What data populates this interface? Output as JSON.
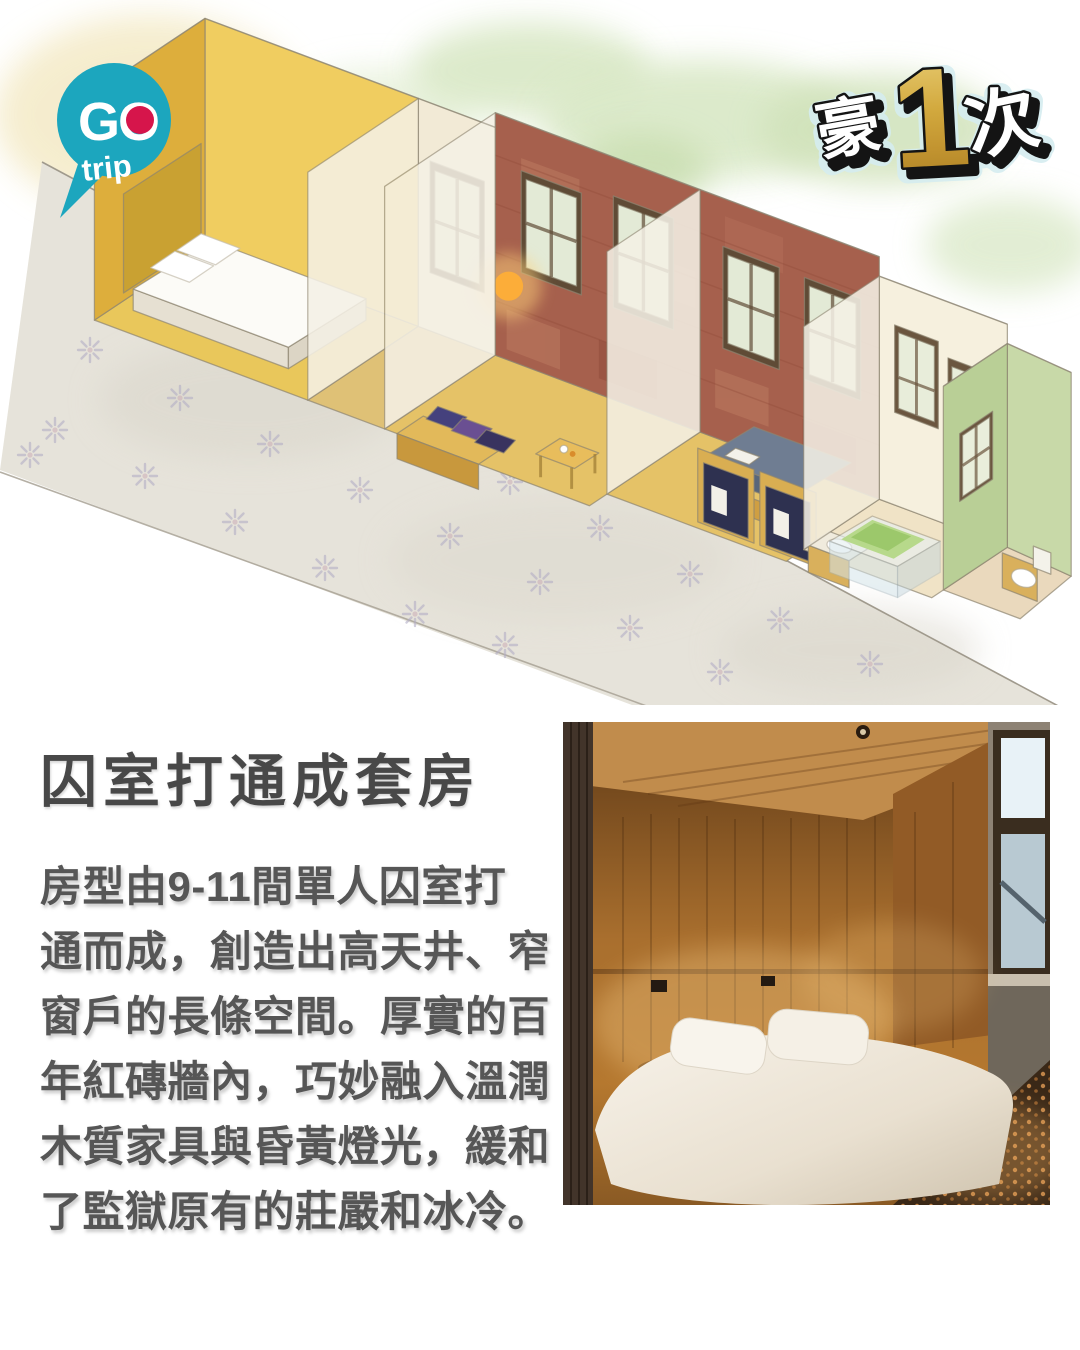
{
  "brand": {
    "go": "GO",
    "trip": "trip"
  },
  "badge": {
    "left": "豪",
    "number": "1",
    "right": "次"
  },
  "article": {
    "heading": "囚室打通成套房",
    "body_lines": [
      "房型由9-11間單人囚室打",
      "通而成，創造出高天井、窄",
      "窗戶的長條空間。厚實的百",
      "年紅磚牆內，巧妙融入溫潤",
      "木質家具與昏黃燈光，緩和",
      "了監獄原有的莊嚴和冰冷。"
    ]
  },
  "palette": {
    "bubble_teal": "#1ca6be",
    "logo_dot_red": "#d6154b",
    "badge_gold": "#cfa43b",
    "heading_gray": "#484848",
    "body_gray": "#565656",
    "walkway_gray": "#e6e3da",
    "starburst_lilac": "#b2aec5",
    "brick_red": "#a6604d",
    "wood_yellow": "#eac75b",
    "toilet_wall_green": "#b9cf96",
    "wash_green": "#d9e8c6",
    "wash_cream": "#f4ebc9",
    "photo_wood_brown": "#a96f2e"
  }
}
